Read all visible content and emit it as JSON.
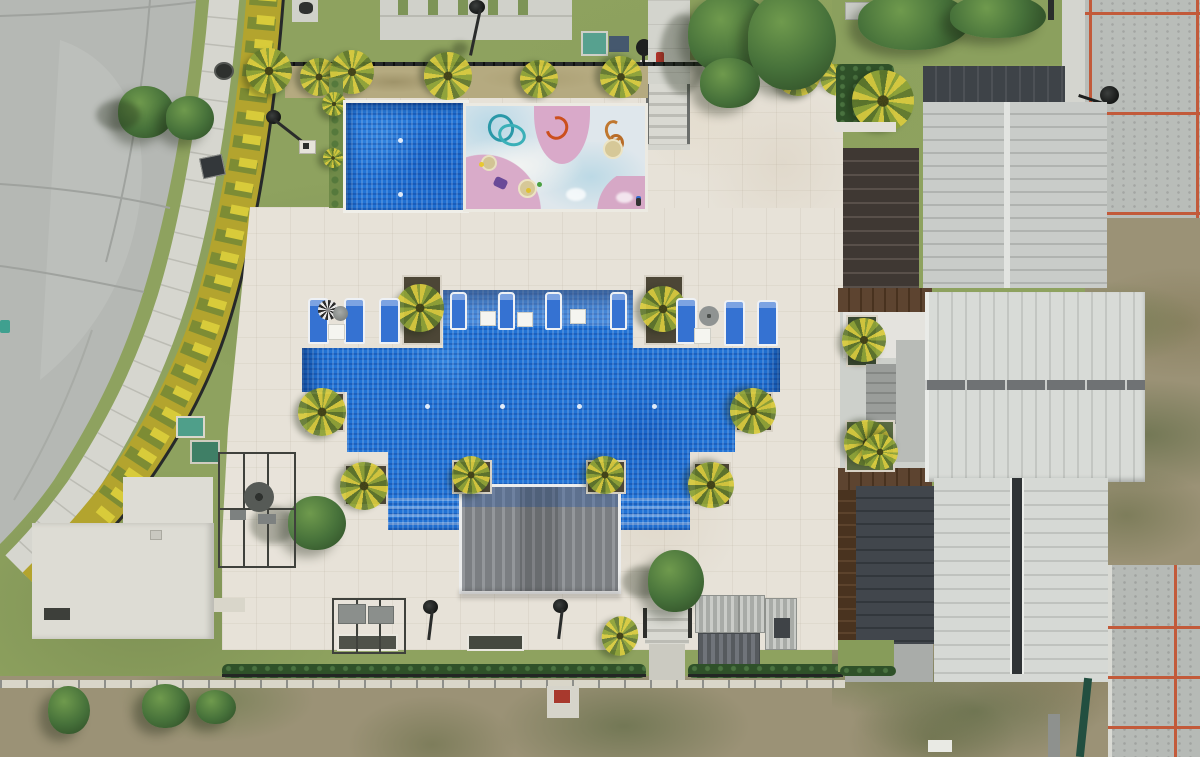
{
  "scene": {
    "type": "aerial-photograph",
    "subject": "residential community pool and clubhouse amenity area",
    "view": "top-down drone view",
    "lighting": "sunny midday, hard shadows"
  },
  "palette": {
    "road_concrete": "#b5b8b4",
    "sidewalk": "#d6d6cf",
    "hedge_yellow_green": "#b3a42e",
    "iron_fence": "#26292a",
    "lush_grass": "#8ea25f",
    "dry_rough_grass": "#9b9276",
    "pool_deck_travertine": "#e7e2d8",
    "pool_water": "#2173d6",
    "pool_shadow": "#0a2f70",
    "splash_pad_base": "#dfe7ec",
    "splash_pad_pink": "#d9a9c9",
    "splash_pad_blue": "#b8d8e6",
    "canopy_gray": "#85888c",
    "lounger_blue": "#3572d2",
    "roof_light_ribbed": "#c9ccc9",
    "roof_white_seamed": "#d8dbd7",
    "roof_charcoal": "#3e4348",
    "roof_dark_brown": "#4a3526",
    "parking_stall_red": "#c25a3a",
    "spa_pad_teal": "#4f9f8a"
  },
  "areas": {
    "road": {
      "name": "curved access road",
      "features": [
        "curved sidewalk",
        "grass verge",
        "expansion joints",
        "manhole cover",
        "utility pad"
      ]
    },
    "north_garden": {
      "features": [
        "paver patio with grass joints",
        "lamp post",
        "teal pad",
        "blue mat",
        "round grill",
        "entry walkway with steps"
      ]
    },
    "lap_pool": {
      "shape": "rectangle",
      "water": "blue mosaic tile",
      "underwater_lights": 2
    },
    "splash_pad": {
      "base": "pastel play surface",
      "blobs": [
        "pink fan",
        "pink quarter circles",
        "light blue zones",
        "white wave"
      ],
      "play_features": [
        "teal loop sprayer",
        "orange hook sprayer",
        "orange squiggle sprayer",
        "tan spray domes",
        "purple toy"
      ],
      "people": 1
    },
    "main_pool": {
      "shape": "stepped cross / ziggurat",
      "in_water_loungers": 4,
      "floating_side_tables": 3,
      "underwater_lights": 4,
      "step_entries": 2,
      "tanning_ledge": true
    },
    "canopy": {
      "type": "ribbed polycarbonate shade structure over swim-up steps"
    },
    "deck_furniture": {
      "deck_loungers": 6,
      "umbrellas": 3,
      "side_tables": 4,
      "planters_with_palms": 8,
      "benches": 2,
      "lamp_posts": 6
    },
    "south_edge": {
      "features": [
        "hedge row",
        "iron fence",
        "gravel strip",
        "entry gate with steps",
        "slat pergola loungers",
        "sign pad with red marker"
      ]
    },
    "west_buildings": {
      "white_flat_roof_building": 1,
      "steel_pergola_frames": 2,
      "spa_pads": 2
    },
    "east_buildings": {
      "count": 3,
      "roofs": [
        "charcoal vertical seam",
        "light gray ribbed",
        "white vertical seam with center gutter",
        "white ribbed with dark skylight channel",
        "dark brown plank"
      ],
      "clubhouse_planters": 4
    },
    "parking_lots": {
      "count": 2,
      "stall_line_color": "red-orange",
      "lamp_posts": 1
    }
  }
}
